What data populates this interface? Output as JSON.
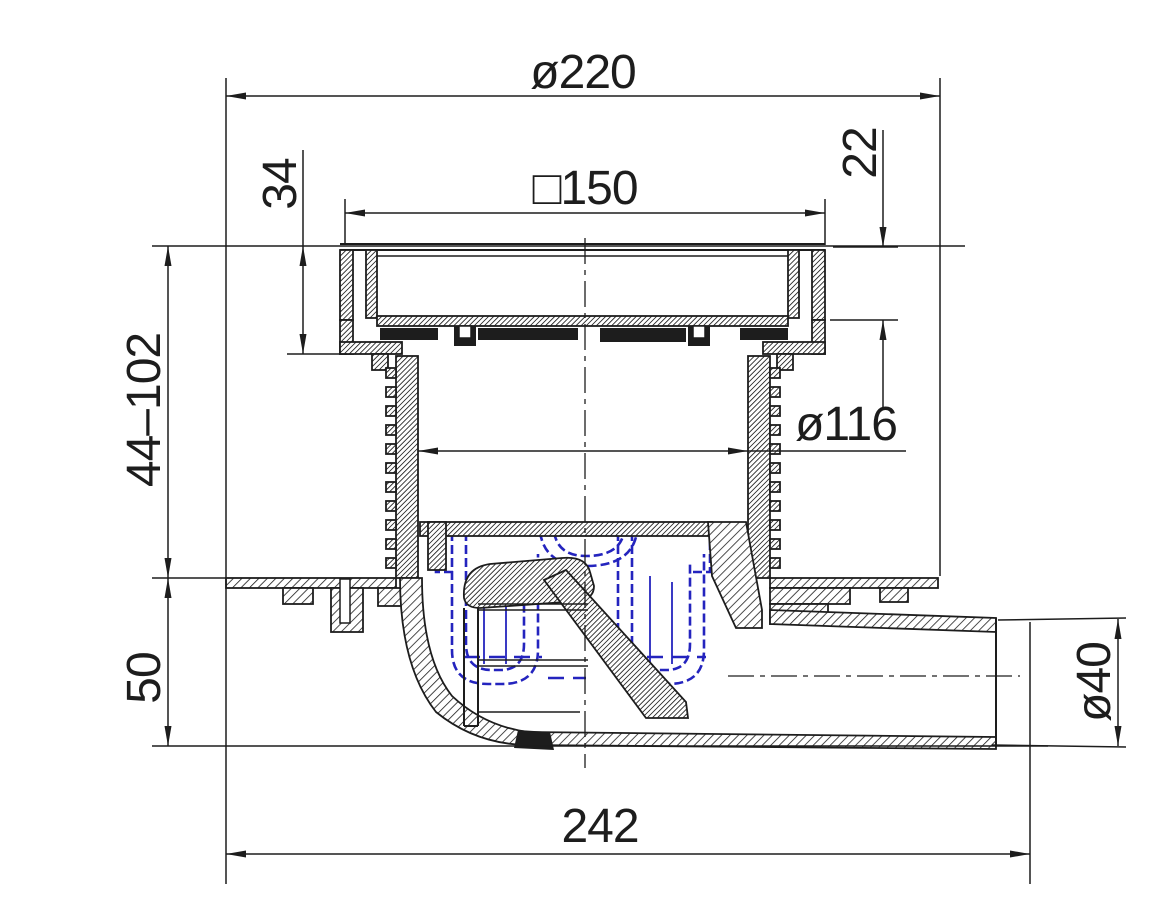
{
  "drawing": {
    "title": "floor-drain-cross-section",
    "colors": {
      "line": "#1d1d1d",
      "trap_highlight": "#2424be",
      "background": "#ffffff"
    },
    "dimensions": {
      "top_diameter": "ø220",
      "grate_square": "□150",
      "frame_edge_height": "22",
      "frame_height": "34",
      "adjustable_height": "44–102",
      "trap_body_height": "50",
      "riser_inner_diameter": "ø116",
      "outlet_diameter": "ø40",
      "overall_width": "242"
    }
  }
}
